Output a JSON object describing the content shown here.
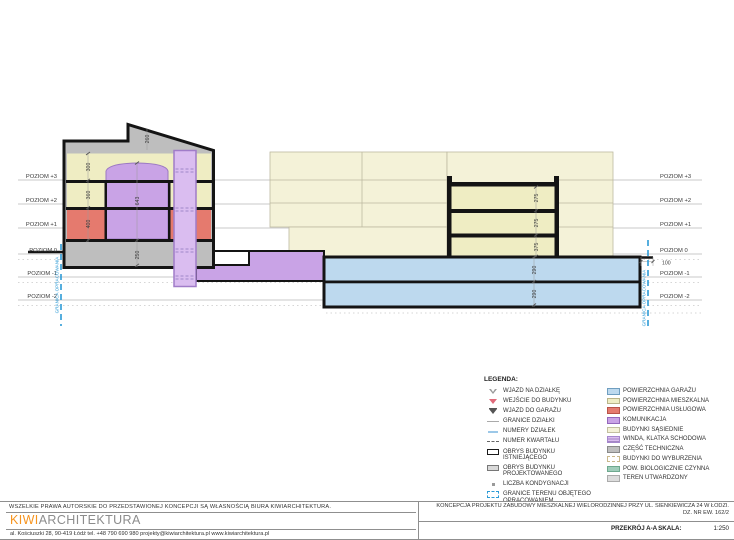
{
  "drawing": {
    "levels": [
      "POZIOM +3",
      "POZIOM +2",
      "POZIOM +1",
      "POZIOM 0",
      "POZIOM -1",
      "POZIOM -2"
    ],
    "dims": {
      "left_roof": "260",
      "left_f3": "300",
      "left_f2": "360",
      "left_f1": "400",
      "left_atrium": "643",
      "left_base": "250",
      "right_f1": "275",
      "right_f2": "275",
      "right_f3": "375",
      "garage_l1": "290",
      "garage_l2": "290",
      "offset": "100"
    },
    "boundary_label": "GRANICA OPRACOWANIA"
  },
  "legend": {
    "title": "LEGENDA:",
    "symbols": [
      {
        "label": "WJAZD NA DZIAŁKĘ"
      },
      {
        "label": "WEJŚCIE DO BUDYNKU"
      },
      {
        "label": "WJAZD DO GARAŻU"
      },
      {
        "label": "GRANICE DZIAŁKI"
      },
      {
        "label": "NUMERY DZIAŁEK"
      },
      {
        "label": "NUMER KWARTAŁU"
      },
      {
        "label": "OBRYS BUDYNKU ISTNIEJĄCEGO"
      },
      {
        "label": "OBRYS BUDYNKU PROJEKTOWANEGO"
      },
      {
        "label": "LICZBA KONDYGNACJI"
      },
      {
        "label": "GRANICE TERENU OBJĘTEGO OPRACOWANIEM"
      }
    ],
    "areas": [
      {
        "label": "POWIERZCHNIA GARAŻU",
        "color": "#BDD9EE",
        "border": "#6F9EC0"
      },
      {
        "label": "POWIERZCHNIA MIESZKALNA",
        "color": "#EFEDC4",
        "border": "#B9B48A"
      },
      {
        "label": "POWIERZCHNIA USŁUGOWA",
        "color": "#E57A6E",
        "border": "#B95348"
      },
      {
        "label": "KOMUNIKACJA",
        "color": "#C9A3E6",
        "border": "#9468BC"
      },
      {
        "label": "BUDYNKI SĄSIEDNIE",
        "color": "#F4F2D8",
        "border": "#C2BFA0"
      },
      {
        "label": "WINDA, KLATKA SCHODOWA",
        "color": "#DABDF0",
        "border": "#A687CD"
      },
      {
        "label": "CZĘŚĆ TECHNICZNA",
        "color": "#BEBEBE",
        "border": "#8A8A8A"
      },
      {
        "label": "BUDYNKI DO WYBURZENIA",
        "color": "#FFFFFF",
        "border": "#C9B88C"
      },
      {
        "label": "POW. BIOLOGICZNIE CZYNNA",
        "color": "#9FCDBA",
        "border": "#6FA98F"
      },
      {
        "label": "TEREN UTWARDZONY",
        "color": "#DCDCDC",
        "border": "#ABABAB"
      }
    ]
  },
  "titleblock": {
    "copyright": "WSZELKIE PRAWA AUTORSKIE DO PRZEDSTAWIONEJ KONCEPCJI SĄ WŁASNOŚCIĄ BIURA KIWIARCHITEKTURA.",
    "logo_kiwi": "KIWI",
    "logo_rest": "ARCHITEKTURA",
    "address": "al. Kościuszki 28, 90-419 Łódź    tel. +48 790 690 980    projekty@kiwiarchitektura.pl    www.kiwiarchitektura.pl",
    "project_line1": "KONCEPCJA PROJEKTU ZABUDOWY MIESZKALNEJ WIELORODZINNEJ PRZY UL. SIENKIEWICZA 24 W ŁODZI.",
    "project_line2": "DZ. NR EW. 162/2",
    "sheet_name": "PRZEKRÓJ A-A",
    "scale_label": "SKALA:",
    "scale_value": "1:250"
  }
}
